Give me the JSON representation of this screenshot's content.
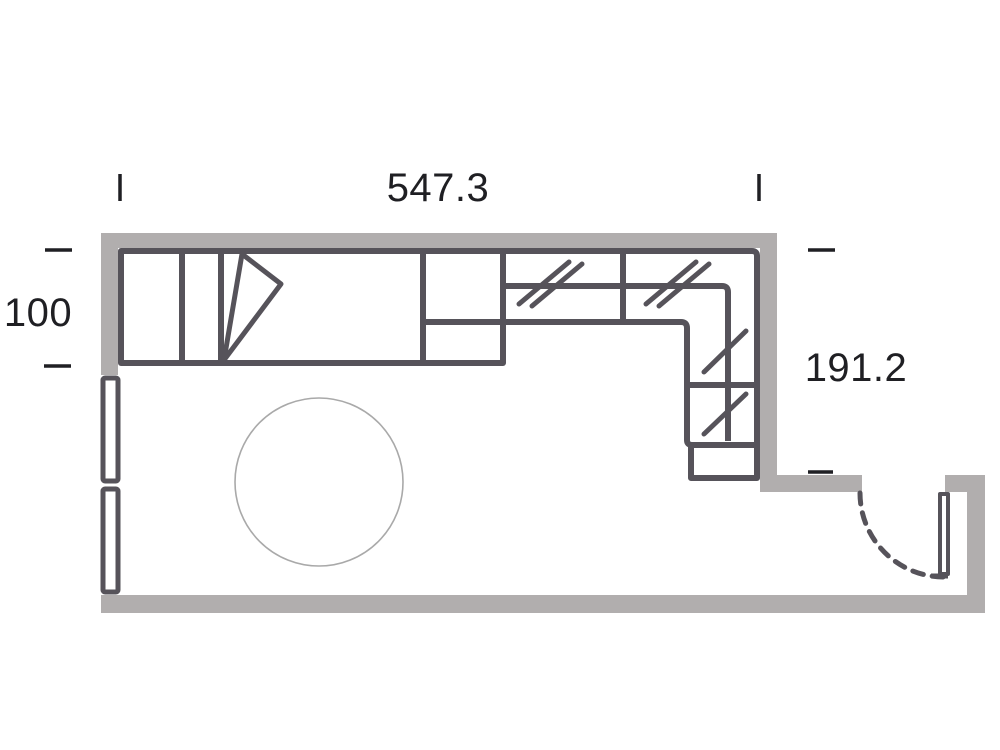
{
  "plan": {
    "type": "floor-plan",
    "dimensions": {
      "top": "547.3",
      "left": "100",
      "right": "191.2"
    },
    "colors": {
      "background": "#ffffff",
      "wall_fill": "#b1aeae",
      "furniture_stroke": "#56535a",
      "table_stroke": "#a9a9a9",
      "dimension_text": "#1f1f23"
    },
    "icons": {
      "hanging_rail": "double-diagonal-slash",
      "door_swing": "dashed-quarter-arc",
      "hinged_door": "open-triangle"
    }
  }
}
